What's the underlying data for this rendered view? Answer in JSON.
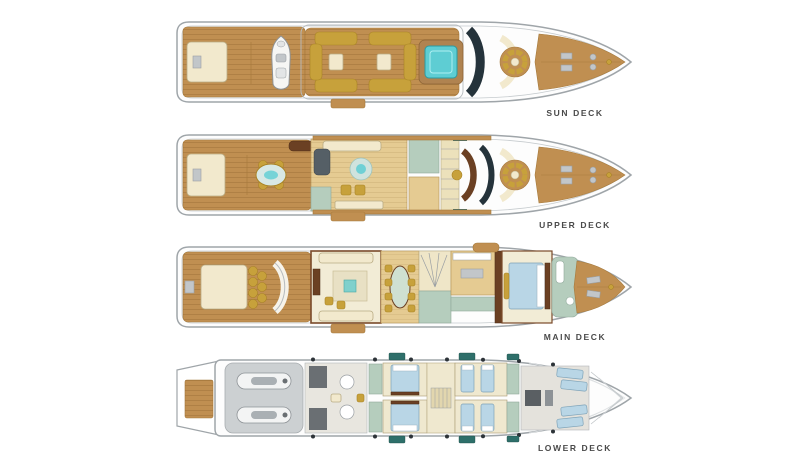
{
  "title": "Yacht deck plans",
  "palette": {
    "teak": "#c08f51",
    "teak_line": "#a67a3c",
    "cream": "#f2e9cd",
    "gold": "#c7a13b",
    "jacuzzi": "#5ecdd3",
    "glass": "#25333b",
    "wood": "#e5cb92",
    "marble": "#b5cdbd",
    "bed": "#b9d6e6",
    "darkwood": "#6b4023",
    "garage": "#ccd0d2",
    "hullstroke": "#9fa5a9",
    "label": "#4a4a4a"
  },
  "decks": [
    {
      "label": "SUN DECK"
    },
    {
      "label": "UPPER DECK"
    },
    {
      "label": "MAIN DECK"
    },
    {
      "label": "LOWER DECK"
    }
  ]
}
